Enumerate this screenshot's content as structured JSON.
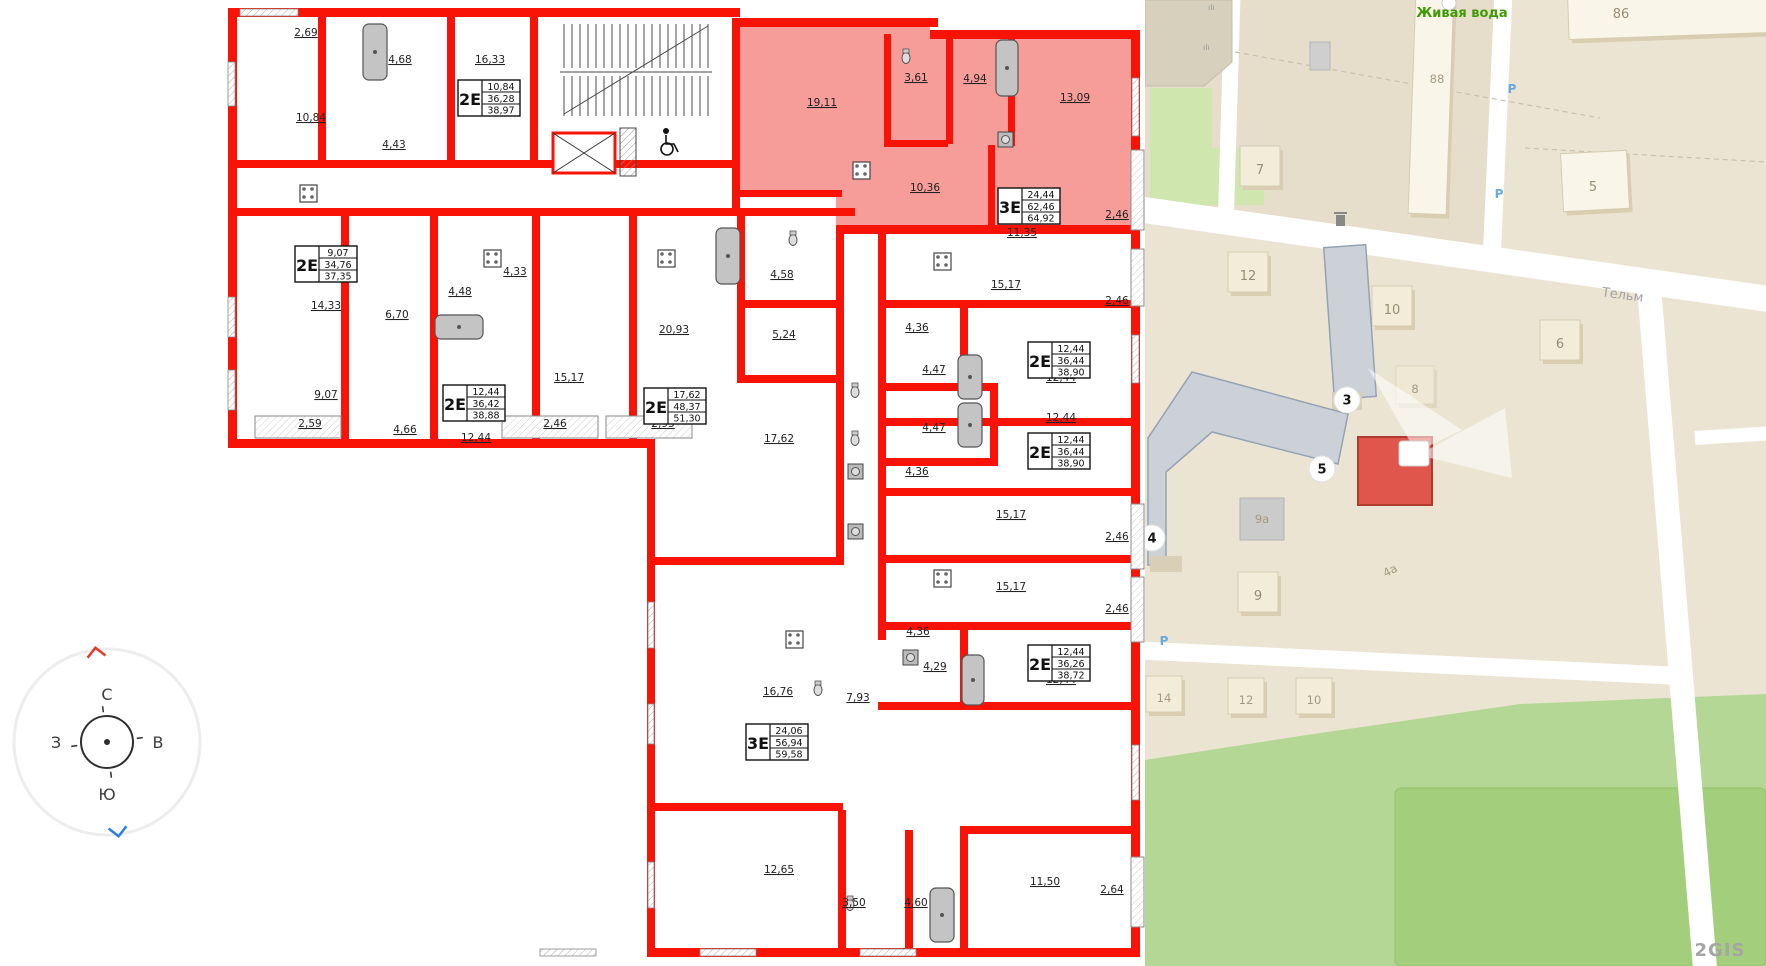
{
  "floorplan": {
    "wall_color": "#f81306",
    "highlight_fill": "#f5928e",
    "room_labels": [
      {
        "t": "2,69",
        "x": 306,
        "y": 36
      },
      {
        "t": "4,68",
        "x": 400,
        "y": 63
      },
      {
        "t": "16,33",
        "x": 490,
        "y": 63
      },
      {
        "t": "10,84",
        "x": 311,
        "y": 121
      },
      {
        "t": "4,43",
        "x": 394,
        "y": 148
      },
      {
        "t": "19,11",
        "x": 822,
        "y": 106
      },
      {
        "t": "3,61",
        "x": 916,
        "y": 81
      },
      {
        "t": "4,94",
        "x": 975,
        "y": 82
      },
      {
        "t": "13,09",
        "x": 1075,
        "y": 101
      },
      {
        "t": "10,36",
        "x": 925,
        "y": 191
      },
      {
        "t": "11,35",
        "x": 1022,
        "y": 236
      },
      {
        "t": "2,46",
        "x": 1117,
        "y": 218
      },
      {
        "t": "14,33",
        "x": 326,
        "y": 309
      },
      {
        "t": "6,70",
        "x": 397,
        "y": 318
      },
      {
        "t": "9,07",
        "x": 326,
        "y": 398
      },
      {
        "t": "2,59",
        "x": 310,
        "y": 427
      },
      {
        "t": "4,66",
        "x": 405,
        "y": 433
      },
      {
        "t": "4,48",
        "x": 460,
        "y": 295
      },
      {
        "t": "4,33",
        "x": 515,
        "y": 275
      },
      {
        "t": "12,44",
        "x": 476,
        "y": 441
      },
      {
        "t": "15,17",
        "x": 569,
        "y": 381
      },
      {
        "t": "2,46",
        "x": 555,
        "y": 427
      },
      {
        "t": "20,93",
        "x": 674,
        "y": 333
      },
      {
        "t": "2,93",
        "x": 663,
        "y": 427
      },
      {
        "t": "4,58",
        "x": 782,
        "y": 278
      },
      {
        "t": "5,24",
        "x": 784,
        "y": 338
      },
      {
        "t": "17,62",
        "x": 779,
        "y": 442
      },
      {
        "t": "15,17",
        "x": 1006,
        "y": 288
      },
      {
        "t": "2,46",
        "x": 1117,
        "y": 304
      },
      {
        "t": "4,36",
        "x": 917,
        "y": 331
      },
      {
        "t": "4,47",
        "x": 934,
        "y": 373
      },
      {
        "t": "12,44",
        "x": 1061,
        "y": 381
      },
      {
        "t": "12,44",
        "x": 1061,
        "y": 421
      },
      {
        "t": "4,47",
        "x": 934,
        "y": 431
      },
      {
        "t": "4,36",
        "x": 917,
        "y": 475
      },
      {
        "t": "15,17",
        "x": 1011,
        "y": 518
      },
      {
        "t": "2,46",
        "x": 1117,
        "y": 540
      },
      {
        "t": "15,17",
        "x": 1011,
        "y": 590
      },
      {
        "t": "2,46",
        "x": 1117,
        "y": 612
      },
      {
        "t": "4,36",
        "x": 918,
        "y": 635
      },
      {
        "t": "4,29",
        "x": 935,
        "y": 670
      },
      {
        "t": "12,44",
        "x": 1061,
        "y": 683
      },
      {
        "t": "7,93",
        "x": 858,
        "y": 701
      },
      {
        "t": "16,76",
        "x": 778,
        "y": 695
      },
      {
        "t": "12,65",
        "x": 779,
        "y": 873
      },
      {
        "t": "3,50",
        "x": 854,
        "y": 906
      },
      {
        "t": "4,60",
        "x": 916,
        "y": 906
      },
      {
        "t": "11,50",
        "x": 1045,
        "y": 885
      },
      {
        "t": "2,64",
        "x": 1112,
        "y": 893
      }
    ],
    "unit_boxes": [
      {
        "type": "2Е",
        "rows": [
          "10,84",
          "36,28",
          "38,97"
        ],
        "x": 458,
        "y": 80
      },
      {
        "type": "2Е",
        "rows": [
          "9,07",
          "34,76",
          "37,35"
        ],
        "x": 295,
        "y": 246
      },
      {
        "type": "2Е",
        "rows": [
          "12,44",
          "36,42",
          "38,88"
        ],
        "x": 443,
        "y": 385
      },
      {
        "type": "2Е",
        "rows": [
          "17,62",
          "48,37",
          "51,30"
        ],
        "x": 644,
        "y": 388
      },
      {
        "type": "3Е",
        "rows": [
          "24,44",
          "62,46",
          "64,92"
        ],
        "x": 998,
        "y": 188
      },
      {
        "type": "2Е",
        "rows": [
          "12,44",
          "36,44",
          "38,90"
        ],
        "x": 1028,
        "y": 342
      },
      {
        "type": "2Е",
        "rows": [
          "12,44",
          "36,44",
          "38,90"
        ],
        "x": 1028,
        "y": 433
      },
      {
        "type": "2Е",
        "rows": [
          "12,44",
          "36,26",
          "38,72"
        ],
        "x": 1028,
        "y": 645
      },
      {
        "type": "3Е",
        "rows": [
          "24,06",
          "56,94",
          "59,58"
        ],
        "x": 746,
        "y": 724
      }
    ]
  },
  "compass": {
    "north": "С",
    "south": "Ю",
    "west": "З",
    "east": "В"
  },
  "map": {
    "poi": {
      "name": "Живая вода",
      "x": 1462,
      "y": 17
    },
    "street": {
      "name": "Тельм",
      "x": 1622,
      "y": 299,
      "rot": 8
    },
    "diag_label": {
      "t": "4а",
      "x": 1392,
      "y": 574,
      "rot": -28
    },
    "watermark": {
      "t": "2GIS",
      "x": 1720,
      "y": 956
    },
    "parking_letter": "Р",
    "parking": [
      {
        "x": 1512,
        "y": 93
      },
      {
        "x": 1499,
        "y": 198
      },
      {
        "x": 1164,
        "y": 645
      }
    ],
    "buildings": [
      {
        "label": "86",
        "x": 1568,
        "y": -22,
        "w": 200,
        "h": 58,
        "rot": -2,
        "lx": 1621,
        "ly": 14,
        "white": true
      },
      {
        "label": "88",
        "x": 1412,
        "y": -8,
        "w": 38,
        "h": 222,
        "rot": 2,
        "lx": 1437,
        "ly": 79,
        "white": true
      },
      {
        "label": "7",
        "x": 1240,
        "y": 146,
        "w": 40,
        "h": 40,
        "rot": 0,
        "lx": 1260,
        "ly": 170
      },
      {
        "label": "5",
        "x": 1562,
        "y": 152,
        "w": 66,
        "h": 58,
        "rot": -3,
        "lx": 1593,
        "ly": 187,
        "white": true
      },
      {
        "label": "12",
        "x": 1228,
        "y": 252,
        "w": 40,
        "h": 40,
        "rot": 0,
        "lx": 1248,
        "ly": 276
      },
      {
        "label": "10",
        "x": 1372,
        "y": 286,
        "w": 40,
        "h": 40,
        "rot": 0,
        "lx": 1392,
        "ly": 310
      },
      {
        "label": "6",
        "x": 1540,
        "y": 320,
        "w": 40,
        "h": 40,
        "rot": 0,
        "lx": 1560,
        "ly": 344
      },
      {
        "label": "8",
        "x": 1396,
        "y": 366,
        "w": 38,
        "h": 38,
        "rot": 0,
        "lx": 1415,
        "ly": 389,
        "faint": true
      },
      {
        "label": "9",
        "x": 1238,
        "y": 572,
        "w": 40,
        "h": 40,
        "rot": 0,
        "lx": 1258,
        "ly": 596
      },
      {
        "label": "14",
        "x": 1146,
        "y": 676,
        "w": 36,
        "h": 36,
        "rot": 0,
        "lx": 1164,
        "ly": 698
      },
      {
        "label": "12",
        "x": 1228,
        "y": 678,
        "w": 36,
        "h": 36,
        "rot": 0,
        "lx": 1246,
        "ly": 700
      },
      {
        "label": "10",
        "x": 1296,
        "y": 678,
        "w": 36,
        "h": 36,
        "rot": 0,
        "lx": 1314,
        "ly": 700
      }
    ],
    "grey_building_label": {
      "t": "9а",
      "x": 1240,
      "y": 498,
      "w": 44,
      "h": 42,
      "lx": 1262,
      "ly": 523
    },
    "badges": [
      {
        "n": "3",
        "x": 1347,
        "y": 400
      },
      {
        "n": "4",
        "x": 1152,
        "y": 538
      },
      {
        "n": "5",
        "x": 1322,
        "y": 469
      }
    ]
  }
}
